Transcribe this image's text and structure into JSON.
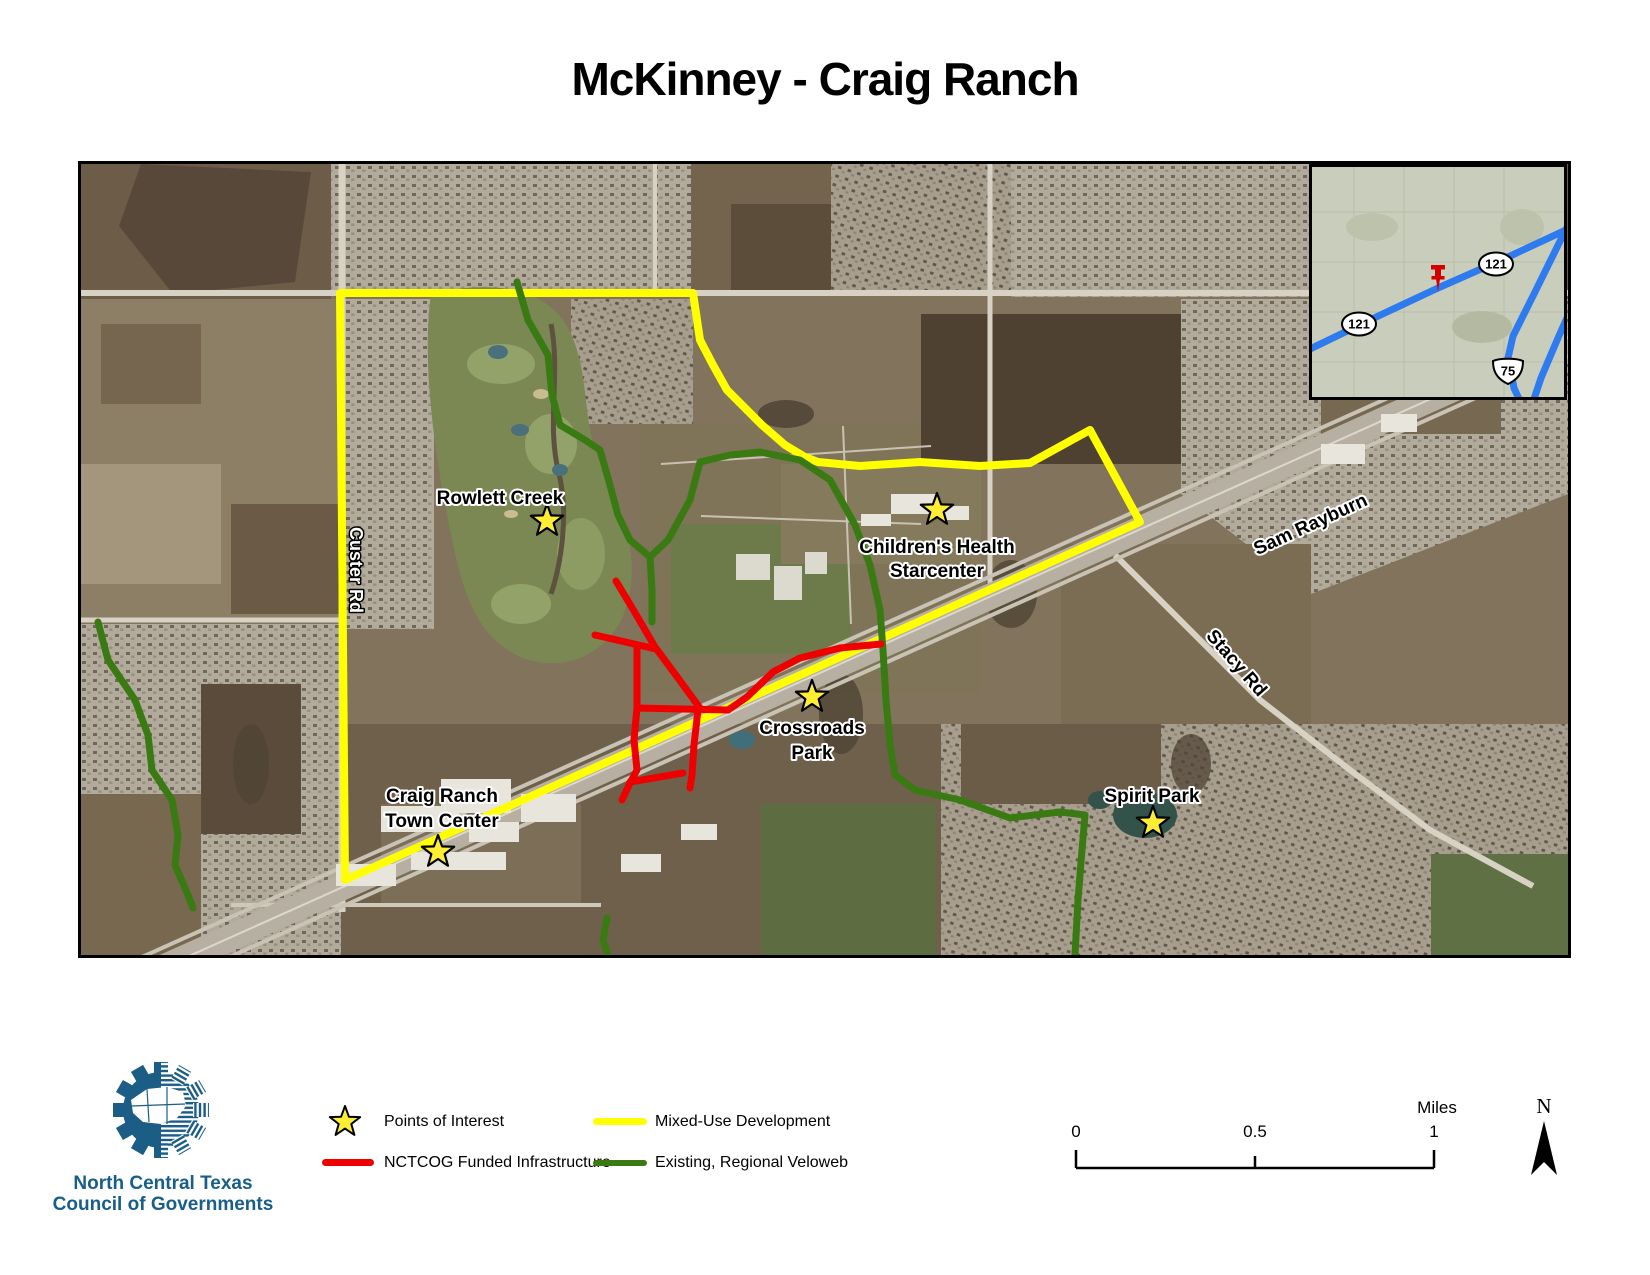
{
  "title": "McKinney - Craig Ranch",
  "map_labels": {
    "rowlett_creek": "Rowlett Creek",
    "childrens_health_1": "Children's Health",
    "childrens_health_2": "Starcenter",
    "crossroads_1": "Crossroads",
    "crossroads_2": "Park",
    "craig_ranch_1": "Craig Ranch",
    "craig_ranch_2": "Town Center",
    "spirit_park": "Spirit Park",
    "custer_rd": "Custer Rd",
    "sam_rayburn": "Sam Rayburn",
    "stacy_rd": "Stacy Rd"
  },
  "inset": {
    "route_121_a": "121",
    "route_121_b": "121",
    "route_75": "75"
  },
  "legend": {
    "points_of_interest": "Points of Interest",
    "mixed_use": "Mixed-Use Development",
    "nctcog": "NCTCOG Funded Infrastructure",
    "veloweb": "Existing, Regional Veloweb"
  },
  "scalebar": {
    "t0": "0",
    "t05": "0.5",
    "t1": "1",
    "unit": "Miles"
  },
  "north_label": "N",
  "logo": {
    "line1": "North Central Texas",
    "line2": "Council of Governments"
  },
  "colors": {
    "mixed_use": "#ffff00",
    "nctcog_red": "#ee0000",
    "veloweb_green": "#3a7a12",
    "inset_highway_blue": "#2e7bf0",
    "star_yellow": "#ffee33",
    "logo_blue": "#1b5d85"
  }
}
